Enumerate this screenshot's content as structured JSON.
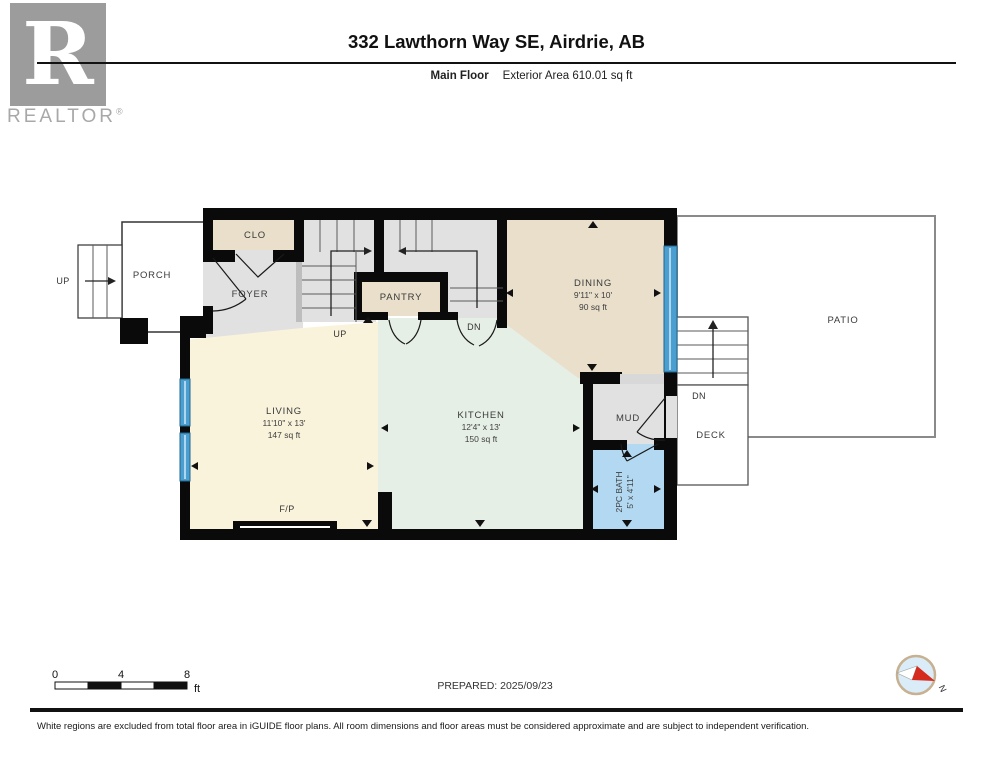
{
  "header": {
    "logo_letter": "R",
    "logo_brand": "REALTOR",
    "logo_reg": "®",
    "title": "332 Lawthorn Way SE, Airdrie, AB",
    "floor_label": "Main Floor",
    "area_label": "Exterior Area 610.01 sq ft"
  },
  "plan": {
    "rooms": {
      "clo": {
        "name": "CLO"
      },
      "foyer": {
        "name": "FOYER"
      },
      "pantry": {
        "name": "PANTRY"
      },
      "dining": {
        "name": "DINING",
        "dims": "9'11\" x 10'",
        "area": "90 sq ft"
      },
      "living": {
        "name": "LIVING",
        "dims": "11'10\" x 13'",
        "area": "147 sq ft"
      },
      "kitchen": {
        "name": "KITCHEN",
        "dims": "12'4\" x 13'",
        "area": "150 sq ft"
      },
      "mud": {
        "name": "MUD"
      },
      "bath": {
        "name": "2PC BATH",
        "dims": "5' x 4'11\""
      },
      "porch": {
        "name": "PORCH"
      },
      "patio": {
        "name": "PATIO"
      },
      "deck": {
        "name": "DECK"
      }
    },
    "labels": {
      "up_porch": "UP",
      "up_stairs": "UP",
      "dn_stairs": "DN",
      "dn_deck": "DN",
      "fireplace": "F/P"
    },
    "compass": {
      "north_label": "N"
    }
  },
  "scale_bar": {
    "tick_0": "0",
    "tick_4": "4",
    "tick_8": "8",
    "unit": "ft"
  },
  "prepared_label": "PREPARED: 2025/09/23",
  "footer_text": "White regions are excluded from total floor area in iGUIDE floor plans. All room dimensions and floor areas must be considered approximate and are subject to independent verification.",
  "colors": {
    "wall": "#0a0a0a",
    "room_beige": "#e9dfcb",
    "room_gray": "#e1e1e1",
    "room_cream": "#faf3dc",
    "room_mint": "#e6efe6",
    "bath_blue": "#b2d9f1",
    "window_blue": "#4a9fd0",
    "compass_red": "#d42b1e"
  }
}
